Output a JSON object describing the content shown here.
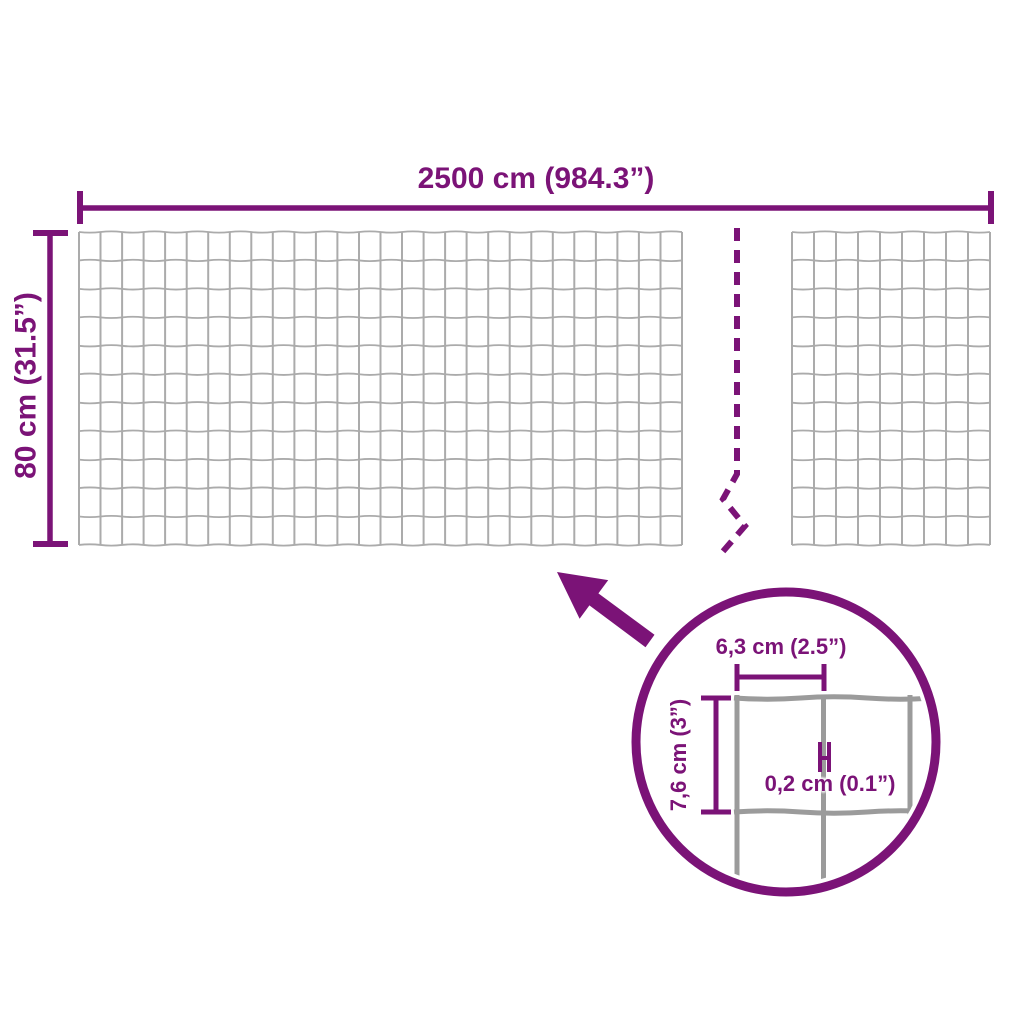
{
  "colors": {
    "accent": "#7B1377",
    "wire_mesh": "#ABABAB",
    "wire_detail": "#9B9B9B",
    "background": "#FFFFFF"
  },
  "main_diagram": {
    "width_label": "2500 cm (984.3”)",
    "height_label": "80 cm (31.5”)"
  },
  "detail_view": {
    "mesh_width_label": "6,3 cm (2.5”)",
    "mesh_height_label": "7,6 cm (3”)",
    "wire_thickness_label": "0,2 cm (0.1”)"
  }
}
